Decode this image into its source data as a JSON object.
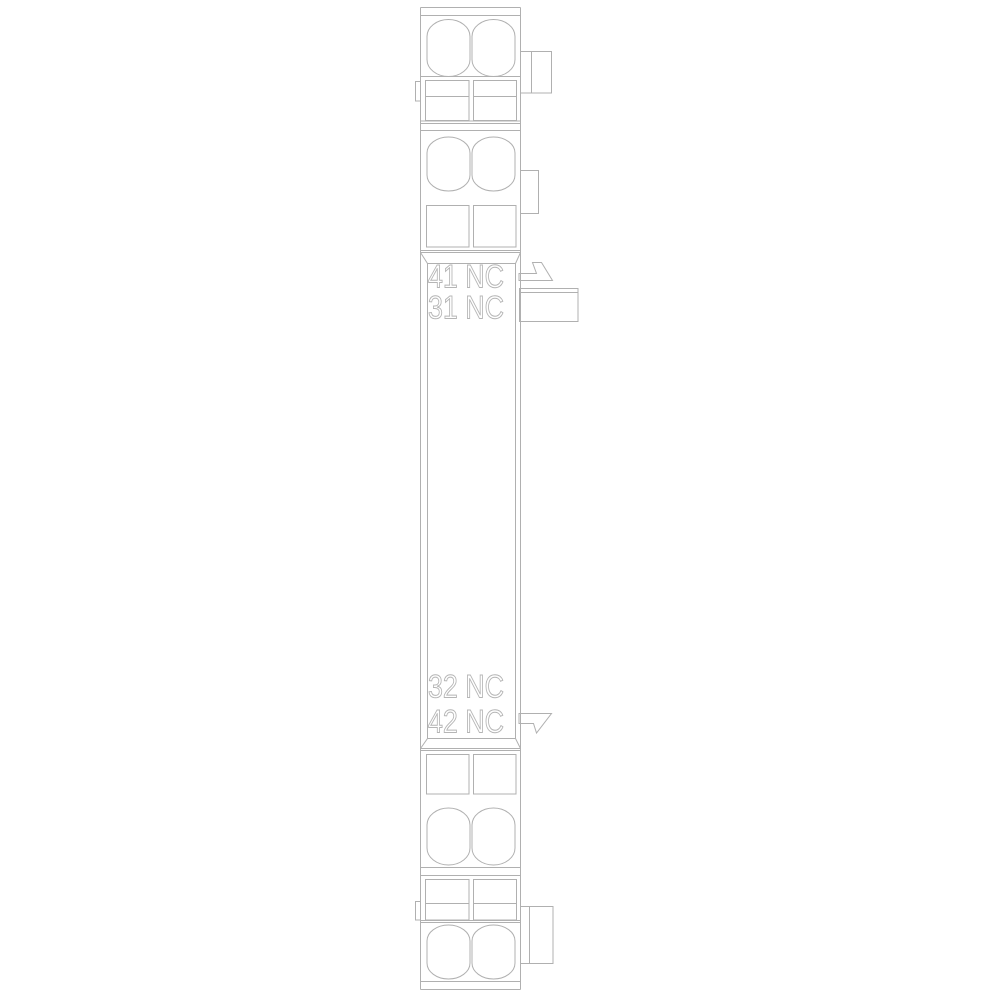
{
  "drawing": {
    "labels": {
      "top": [
        "41 NC",
        "31 NC"
      ],
      "bottom": [
        "32 NC",
        "42 NC"
      ]
    },
    "colors": {
      "line": "#b0b0b0",
      "label_outline": "#b5b5b5",
      "background": "#ffffff"
    },
    "icons": {
      "top_arrow": "arrow-right-icon",
      "bottom_arrow": "arrow-right-icon"
    }
  }
}
